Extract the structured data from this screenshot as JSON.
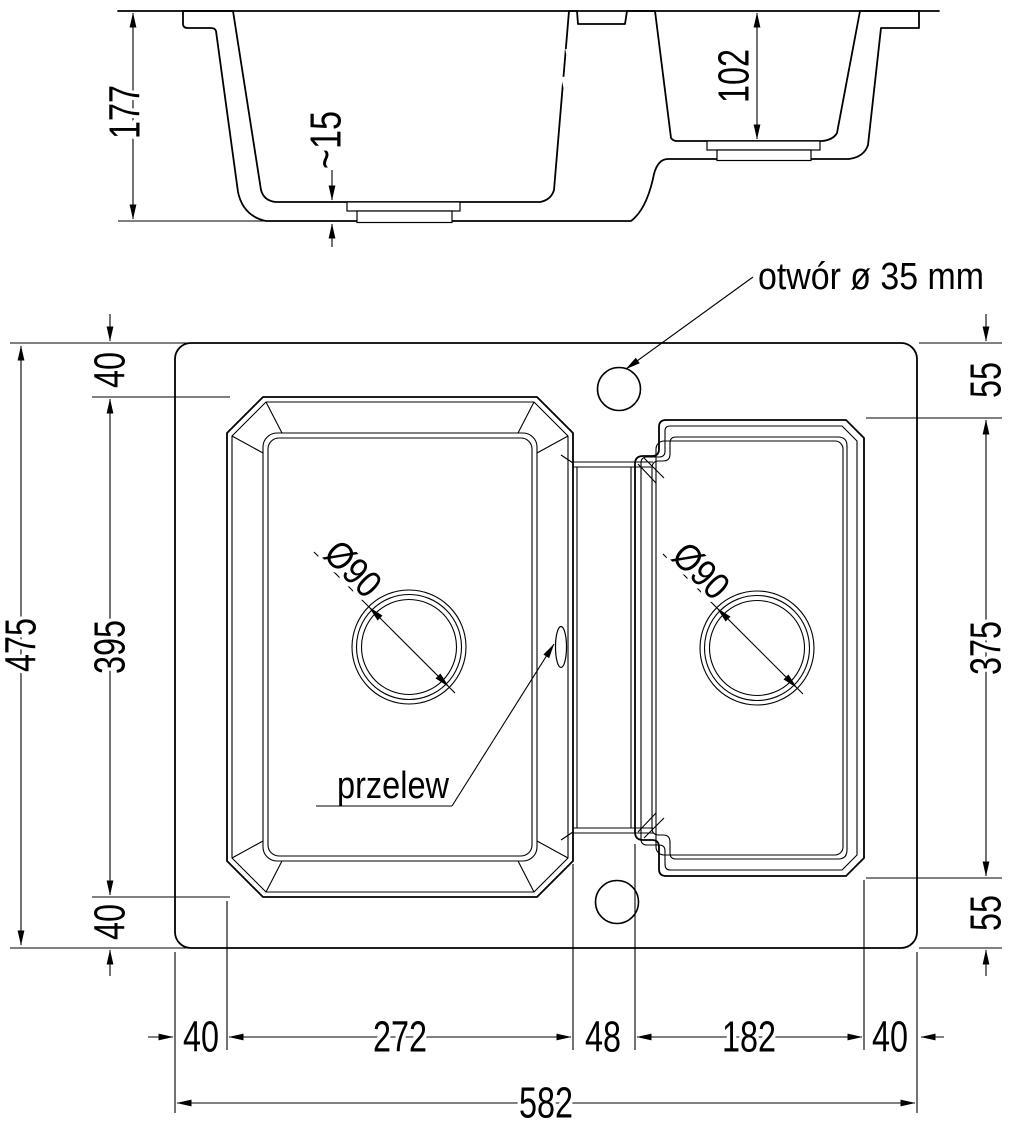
{
  "section": {
    "depth_main": "177",
    "floor_thickness": "~15",
    "depth_small": "102"
  },
  "plan": {
    "hole_label": "otwór ø 35 mm",
    "overflow_label": "przelew",
    "drain_left": "Ø90",
    "drain_right": "Ø90",
    "left": {
      "top": "40",
      "middle": "395",
      "bottom": "40",
      "overall": "475"
    },
    "right": {
      "top": "55",
      "middle": "375",
      "bottom": "55"
    },
    "bottom": {
      "margin_left": "40",
      "bowl_left": "272",
      "divider": "48",
      "bowl_right": "182",
      "margin_right": "40",
      "overall": "582"
    }
  },
  "colors": {
    "line": "#000000",
    "background": "#ffffff"
  }
}
